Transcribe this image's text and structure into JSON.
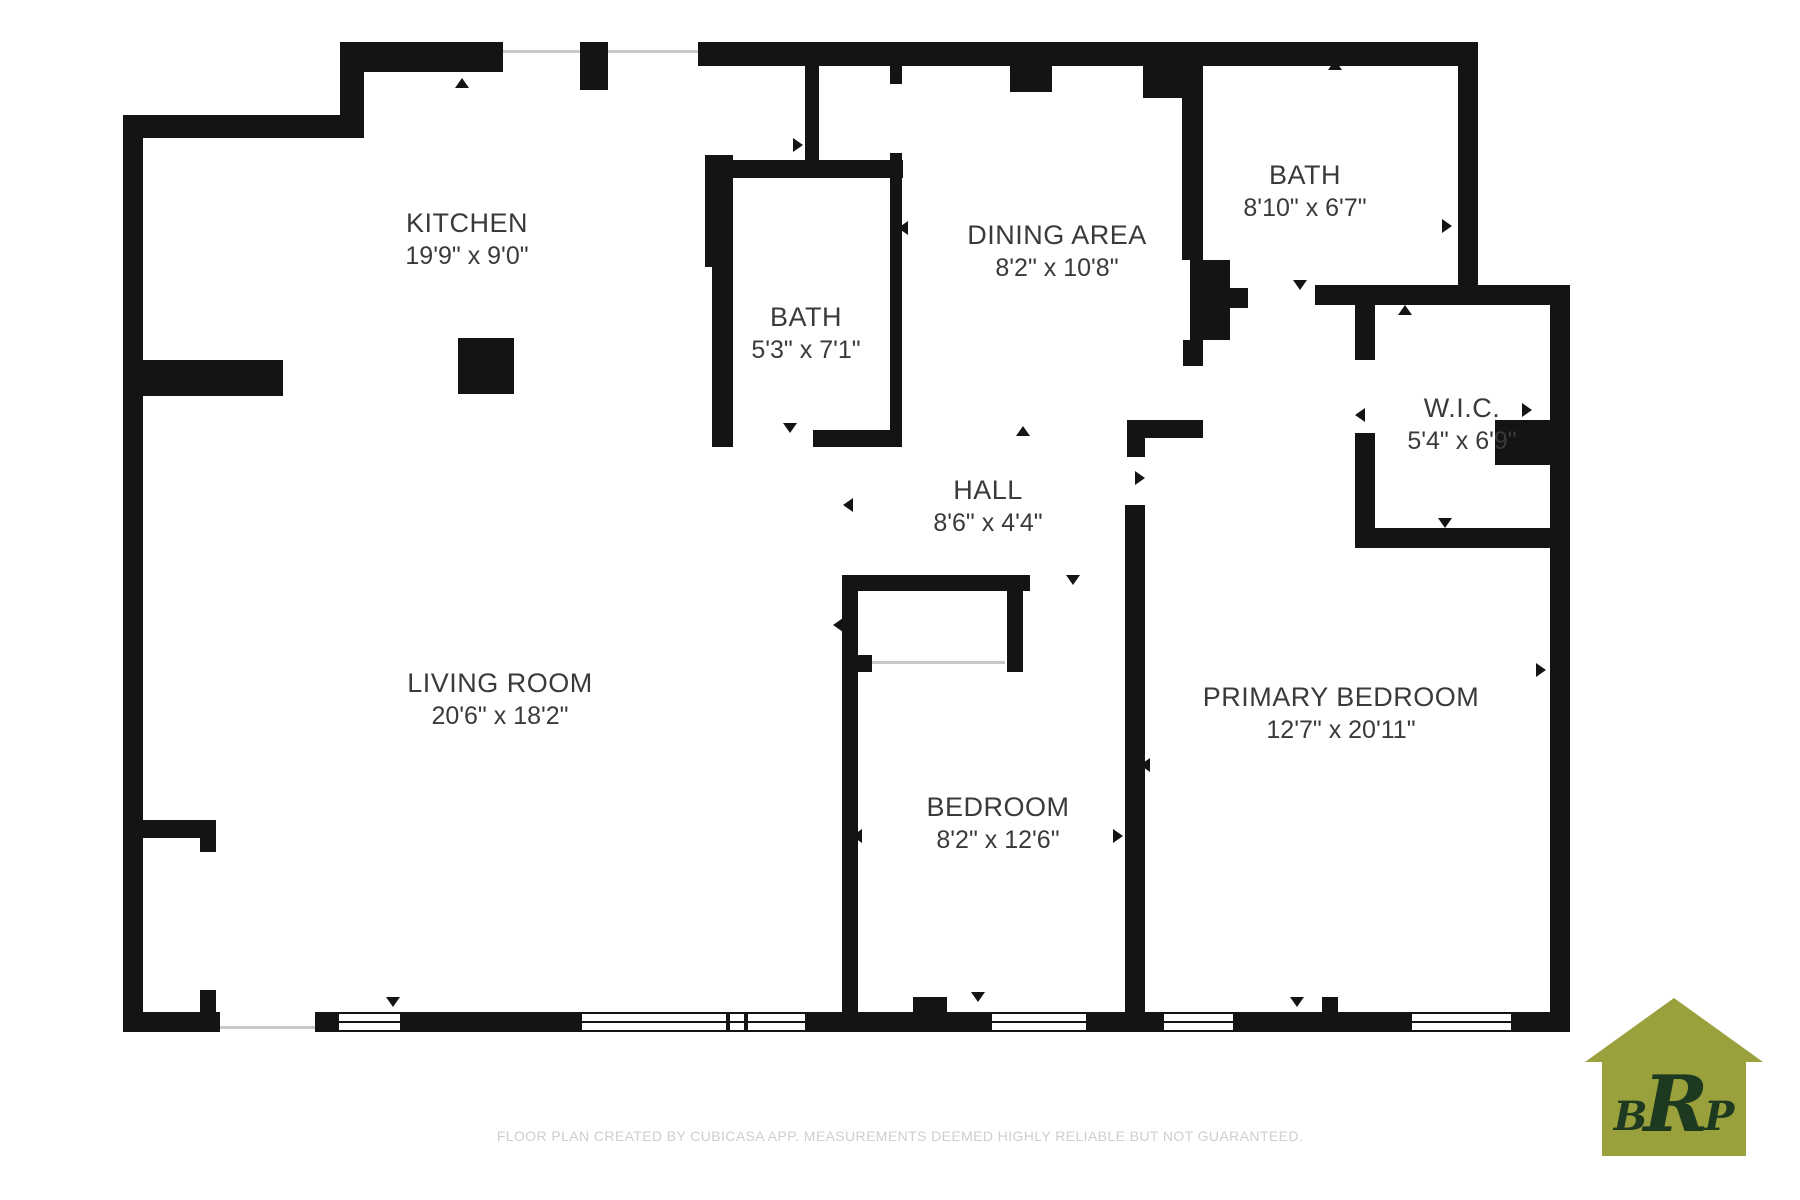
{
  "floor_plan": {
    "rooms": [
      {
        "name": "KITCHEN",
        "dimensions": "19'9\" x 9'0\""
      },
      {
        "name": "BATH",
        "dimensions": "5'3\" x 7'1\""
      },
      {
        "name": "DINING AREA",
        "dimensions": "8'2\" x 10'8\""
      },
      {
        "name": "BATH",
        "dimensions": "8'10\" x 6'7\""
      },
      {
        "name": "W.I.C.",
        "dimensions": "5'4\" x 6'9\""
      },
      {
        "name": "HALL",
        "dimensions": "8'6\" x 4'4\""
      },
      {
        "name": "LIVING ROOM",
        "dimensions": "20'6\" x 18'2\""
      },
      {
        "name": "BEDROOM",
        "dimensions": "8'2\" x 12'6\""
      },
      {
        "name": "PRIMARY BEDROOM",
        "dimensions": "12'7\" x 20'11\""
      }
    ],
    "footer": "FLOOR PLAN CREATED BY CUBICASA APP. MEASUREMENTS DEEMED HIGHLY RELIABLE BUT NOT GUARANTEED.",
    "logo": {
      "letters": [
        "B",
        "R",
        "P"
      ],
      "house_color": "#9aa03b",
      "text_color": "#1d3a21"
    },
    "colors": {
      "wall": "#141414",
      "label": "#3a3a3a",
      "footer_text": "#cbcfd2",
      "background": "#ffffff"
    }
  }
}
